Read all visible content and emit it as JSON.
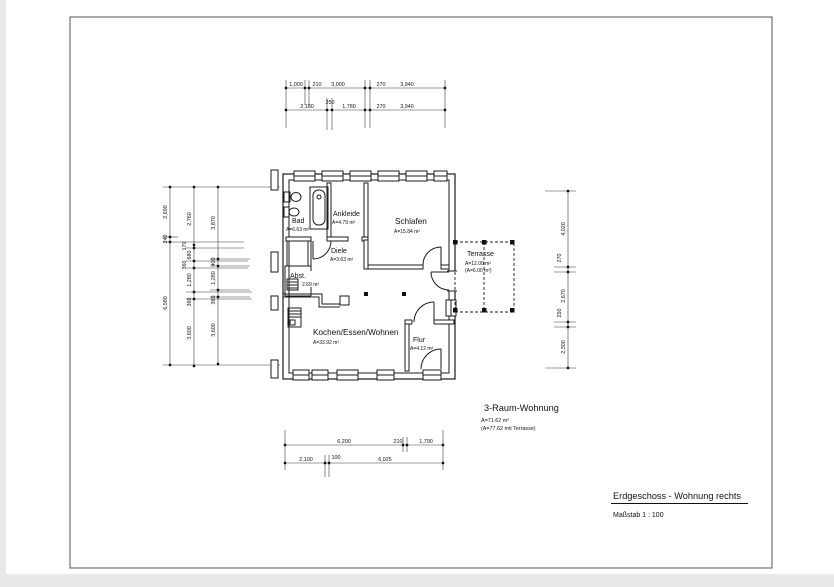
{
  "page": {
    "background": "#ffffff",
    "outside_background": "#e9e9ec",
    "line_color": "#1b1b1b"
  },
  "title_block": {
    "title": "Erdgeschoss - Wohnung rechts",
    "scale_label": "Maßstab  1 : 100"
  },
  "summary": {
    "title": "3-Raum-Wohnung",
    "area": "A=71.62 m²",
    "area_with_terrace": "(A=77.62 mit Terrasse)"
  },
  "rooms": [
    {
      "name": "Bad",
      "area": "A=6.63 m²"
    },
    {
      "name": "Ankleide",
      "area": "A=4.79 m²"
    },
    {
      "name": "Schlafen",
      "area": "A=15.84 m²"
    },
    {
      "name": "Diele",
      "area": "A=3.63 m²"
    },
    {
      "name": "Abst.",
      "area": "2.69 m²"
    },
    {
      "name": "Kochen/Essen/Wohnen",
      "area": "A=33.92 m²"
    },
    {
      "name": "Flur",
      "area": "A=4.12 m²"
    },
    {
      "name": "Terrasse",
      "area": "A=12.00 m²",
      "area2": "(A=6.00 m²)"
    }
  ],
  "dimensions": {
    "top_row1": [
      "1,000",
      "210",
      "3,000",
      "270",
      "3,940"
    ],
    "top_row2": [
      "2,180",
      "250",
      "1,780",
      "270",
      "3,940"
    ],
    "left_outer": [
      "2,690",
      "240",
      "6,580"
    ],
    "left_middle": [
      "2,760",
      "170",
      "680",
      "360",
      "1,280",
      "360",
      "3,600"
    ],
    "left_inner": [
      "3,870",
      "400",
      "1,280",
      "360",
      "3,600"
    ],
    "right": [
      "4,020",
      "270",
      "2,670",
      "250",
      "2,300"
    ],
    "bottom_row1": [
      "6,200",
      "210",
      "1,790"
    ],
    "bottom_row2": [
      "2,100",
      "100",
      "6,025"
    ]
  }
}
